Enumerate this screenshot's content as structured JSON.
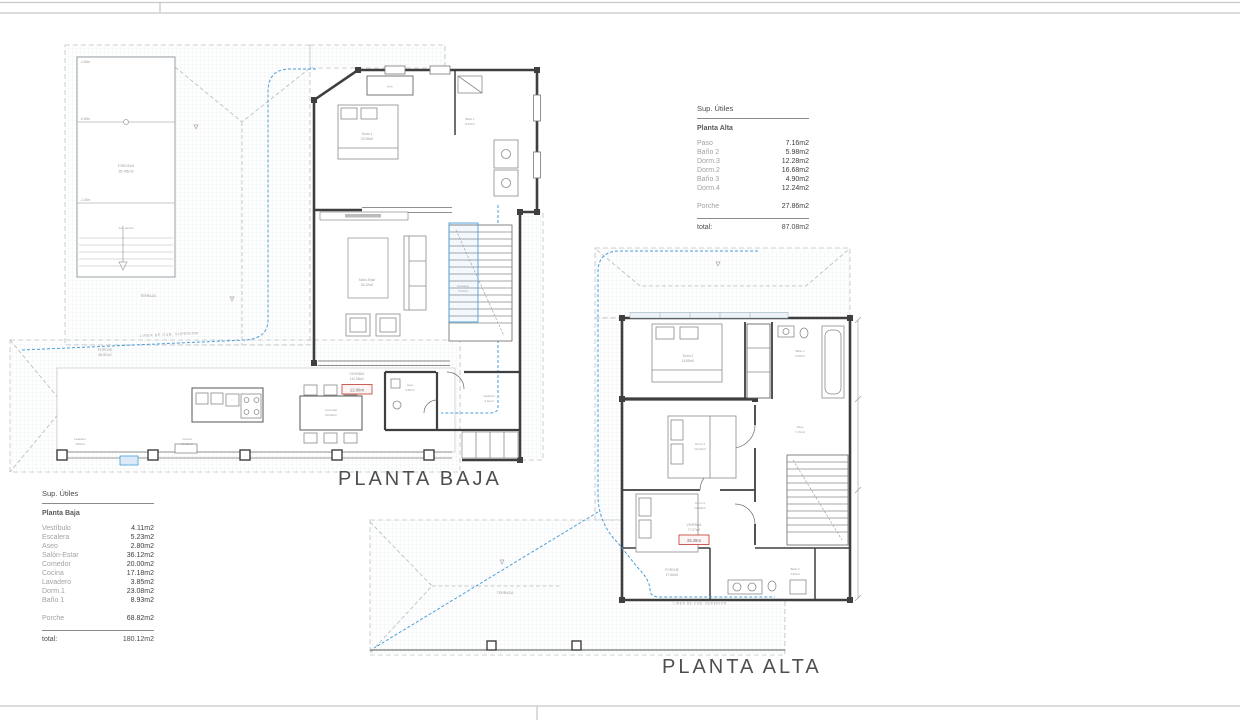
{
  "tables": {
    "planta_baja": {
      "header": "Sup. Útiles",
      "title": "Planta Baja",
      "rows": [
        {
          "label": "Vestíbulo",
          "value": "4.11m2"
        },
        {
          "label": "Escalera",
          "value": "5.23m2"
        },
        {
          "label": "Aseo",
          "value": "2.80m2"
        },
        {
          "label": "Salón-Estar",
          "value": "36.12m2"
        },
        {
          "label": "Comedor",
          "value": "20.00m2"
        },
        {
          "label": "Cocina",
          "value": "17.18m2"
        },
        {
          "label": "Lavadero",
          "value": "3.85m2"
        },
        {
          "label": "Dorm.1",
          "value": "23.08m2"
        },
        {
          "label": "Baño 1",
          "value": "8.93m2"
        }
      ],
      "porche": {
        "label": "Porche",
        "value": "68.82m2"
      },
      "total": {
        "label": "total:",
        "value": "180.12m2"
      }
    },
    "planta_alta": {
      "header": "Sup. Útiles",
      "title": "Planta Alta",
      "rows": [
        {
          "label": "Paso",
          "value": "7.16m2"
        },
        {
          "label": "Baño 2",
          "value": "5.98m2"
        },
        {
          "label": "Dorm.3",
          "value": "12.28m2"
        },
        {
          "label": "Dorm.2",
          "value": "16.68m2"
        },
        {
          "label": "Baño 3",
          "value": "4.90m2"
        },
        {
          "label": "Dorm.4",
          "value": "12.24m2"
        }
      ],
      "porche": {
        "label": "Porche",
        "value": "27.86m2"
      },
      "total": {
        "label": "total:",
        "value": "87.08m2"
      }
    }
  },
  "plan_baja": {
    "title": "PLANTA BAJA",
    "roofline_label": "LINEA DE CUB. SUPERIOR",
    "piscina": {
      "name": "PISCINA",
      "area": "35.45m2",
      "depth_top": "-1.50m",
      "depth_mid": "-0.80m",
      "depth_low": "-1.20m",
      "access": "Acc. piscina"
    },
    "rooms": {
      "dorm1": {
        "name": "Dorm.1",
        "area": "23.08m2"
      },
      "arm": {
        "name": "Arm."
      },
      "bano1": {
        "name": "Baño 1",
        "area": "8.93m2"
      },
      "salon": {
        "name": "Salón-Estar",
        "area": "36.12m2"
      },
      "escalera": {
        "name": "Escalera",
        "area": "5.23m2"
      },
      "aseo": {
        "name": "Aseo",
        "area": "2.80m2"
      },
      "vestibulo": {
        "name": "Vestíbulo",
        "area": "4.11m2"
      },
      "lavadero": {
        "name": "Lavadero",
        "area": "3.85m2"
      },
      "cocina": {
        "name": "Cocina",
        "area": "17.18m2"
      },
      "comedor": {
        "name": "Comedor",
        "area": "20.00m2"
      },
      "porche": {
        "name": "PORCHE",
        "area": "68.82m2"
      },
      "terraza": {
        "name": "TERRAZA"
      }
    },
    "vivienda": {
      "name": "VIVIENDA",
      "area": "142.98m2",
      "cota": "12.00m"
    }
  },
  "plan_alta": {
    "title": "PLANTA ALTA",
    "roofline_label": "LINEA DE CUB. SUPERIOR",
    "rooms": {
      "dorm2": {
        "name": "Dorm.2",
        "area": "16.68m2"
      },
      "bano2": {
        "name": "Baño 2",
        "area": "5.98m2"
      },
      "paso": {
        "name": "Paso",
        "area": "7.16m2"
      },
      "dorm4": {
        "name": "Dorm.4",
        "area": "12.24m2"
      },
      "dorm3": {
        "name": "Dorm.3",
        "area": "12.28m2"
      },
      "bano3": {
        "name": "Baño 3",
        "area": "4.90m2"
      },
      "porche": {
        "name": "PORCHE",
        "area": "27.86m2"
      },
      "terraza": {
        "name": "TERRAZA"
      }
    },
    "vivienda": {
      "name": "VIVIENDA",
      "area": "77.07m2",
      "cota": "35.38m"
    }
  },
  "colors": {
    "roofline_blue": "#4a9fd8",
    "highlight_red": "#c0392b",
    "wall": "#3f3f3f",
    "hatch_line": "#e4e8eb",
    "roof_dash": "#b4b9be",
    "label_gray": "#9c9c9c"
  }
}
